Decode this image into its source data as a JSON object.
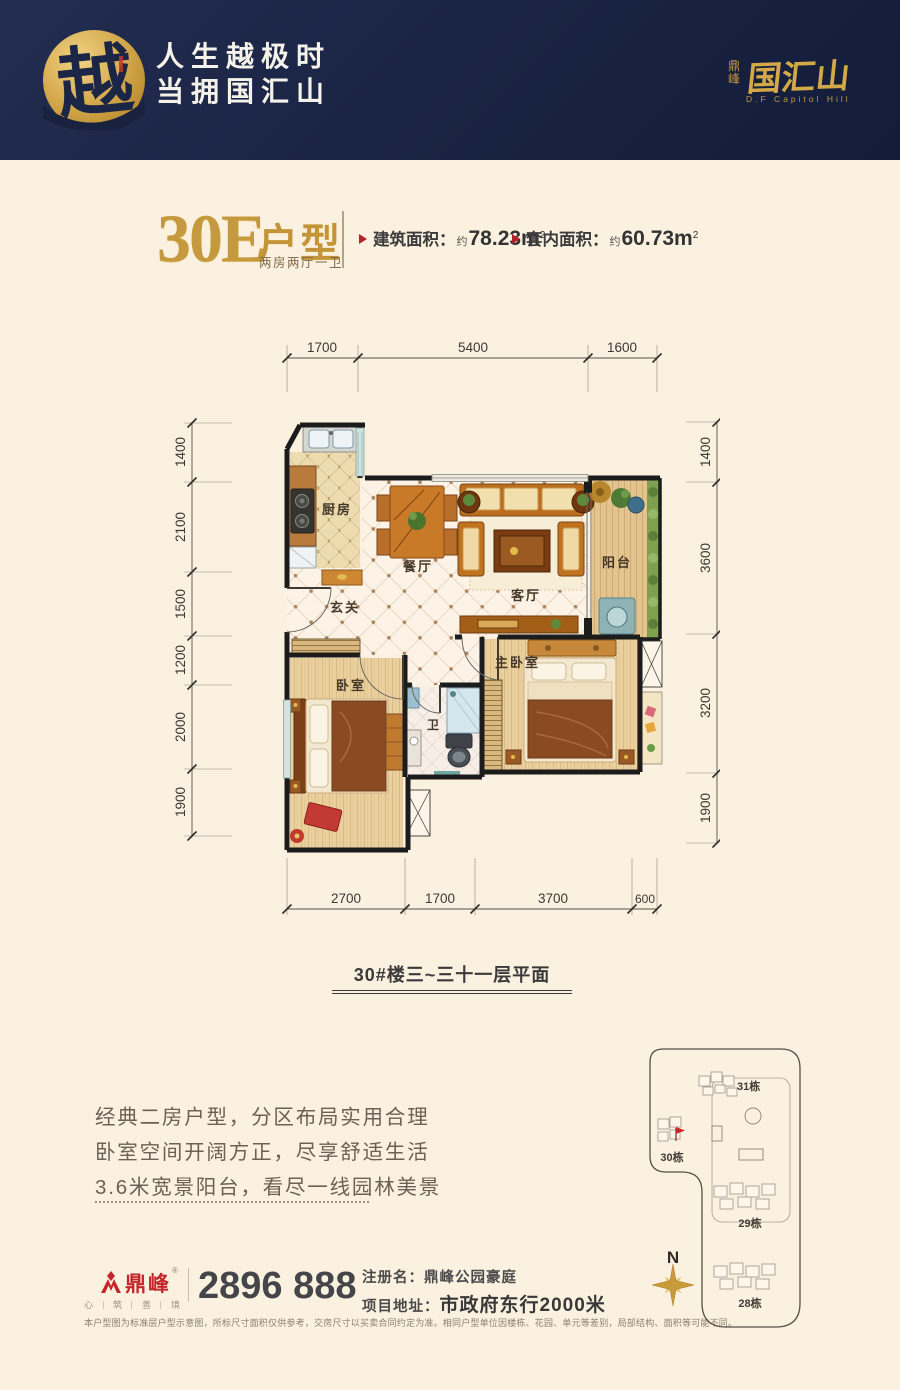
{
  "colors": {
    "navy": "#1b2546",
    "gold": "#c59a3e",
    "accent_red": "#b5232a",
    "brand_red": "#c5262c",
    "cream": "#fbf1e0",
    "wall": "#1c1c1c"
  },
  "header": {
    "logo_char": "越",
    "slogan_line1": "人生越极时",
    "slogan_line2": "当拥国汇山",
    "brand_prefix": "鼎峰",
    "brand_name": "国汇山",
    "brand_tagline": "D.F Capitol Hill"
  },
  "unit": {
    "code": "30E",
    "type_label": "户型",
    "subtitle": "两房两厅一卫",
    "stats": [
      {
        "label": "建筑面积：",
        "approx": "约",
        "value": "78.23m",
        "sup": "2"
      },
      {
        "label": "套内面积：",
        "approx": "约",
        "value": "60.73m",
        "sup": "2"
      }
    ]
  },
  "plan": {
    "caption": "30#楼三~三十一层平面",
    "rooms": {
      "kitchen": "厨房",
      "dining": "餐厅",
      "living": "客厅",
      "balcony": "阳台",
      "entry": "玄关",
      "bedroom": "卧室",
      "master": "主卧室",
      "bath": "卫"
    },
    "dims_top": [
      "1700",
      "5400",
      "1600"
    ],
    "dims_left": [
      "1400",
      "2100",
      "1500",
      "1200",
      "2000",
      "1900"
    ],
    "dims_right": [
      "1400",
      "3600",
      "3200",
      "1900"
    ],
    "dims_bottom": [
      "2700",
      "1700",
      "3700",
      "600"
    ]
  },
  "description": {
    "lines": [
      "经典二房户型，分区布局实用合理",
      "卧室空间开阔方正，尽享舒适生活",
      "3.6米宽景阳台，看尽一线园林美景"
    ]
  },
  "footer": {
    "brand": "鼎峰",
    "reg_mark": "®",
    "motto": [
      "心",
      "筑",
      "善",
      "境"
    ],
    "phone": "2896 888",
    "reg_label": "注册名：",
    "reg_value": "鼎峰公园豪庭",
    "addr_label": "项目地址：",
    "addr_value": "市政府东行2000米",
    "disclaimer": "本户型图为标准层户型示意图，所标尺寸面积仅供参考，交房尺寸以买卖合同约定为准。相同户型单位因楼栋、花园、单元等差别，局部结构、面积等可能不同。"
  },
  "siteplan": {
    "north": "N",
    "buildings": [
      "31栋",
      "30栋",
      "29栋",
      "28栋"
    ]
  }
}
